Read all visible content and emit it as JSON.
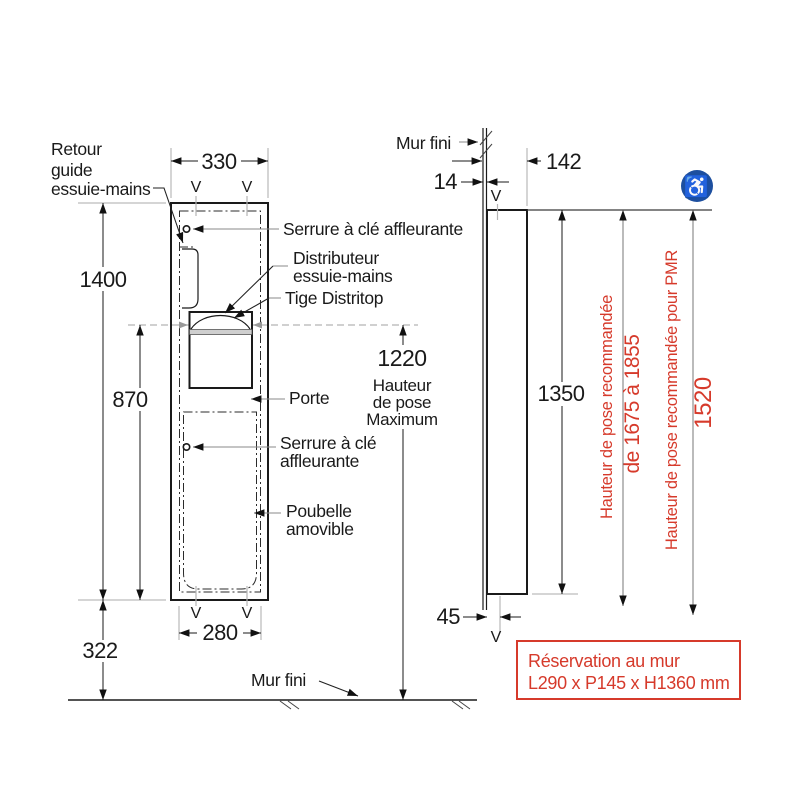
{
  "front": {
    "dim_width": "330",
    "dim_height": "1400",
    "dim_mid": "870",
    "dim_bottom": "322",
    "dim_inner": "280",
    "v": "V",
    "pose": {
      "value": "1220",
      "caption": [
        "Hauteur",
        "de pose",
        "Maximum"
      ]
    },
    "labels": {
      "retour": [
        "Retour",
        "guide",
        "essuie-mains"
      ],
      "serrure_top": "Serrure à clé affleurante",
      "distributeur": [
        "Distributeur",
        "essuie-mains"
      ],
      "tige": "Tige Distritop",
      "porte": "Porte",
      "serrure_bottom": [
        "Serrure à clé",
        "affleurante"
      ],
      "poubelle": [
        "Poubelle",
        "amovible"
      ],
      "mur_fini": "Mur fini"
    }
  },
  "side": {
    "mur_fini": "Mur fini",
    "dim_wall": "14",
    "dim_depth": "142",
    "dim_height": "1350",
    "dim_recess": "45",
    "v": "V",
    "notes": {
      "rec": "Hauteur de pose recommandée",
      "rec_range": "de 1675 à 1855",
      "pmr": "Hauteur de pose recommandée pour PMR",
      "pmr_value": "1520"
    },
    "icon": "♿"
  },
  "reservation": {
    "line1": "Réservation au mur",
    "line2": "L290 x P145 x H1360 mm"
  },
  "colors": {
    "red": "#d63a2b",
    "blue": "#1d4f9f"
  }
}
